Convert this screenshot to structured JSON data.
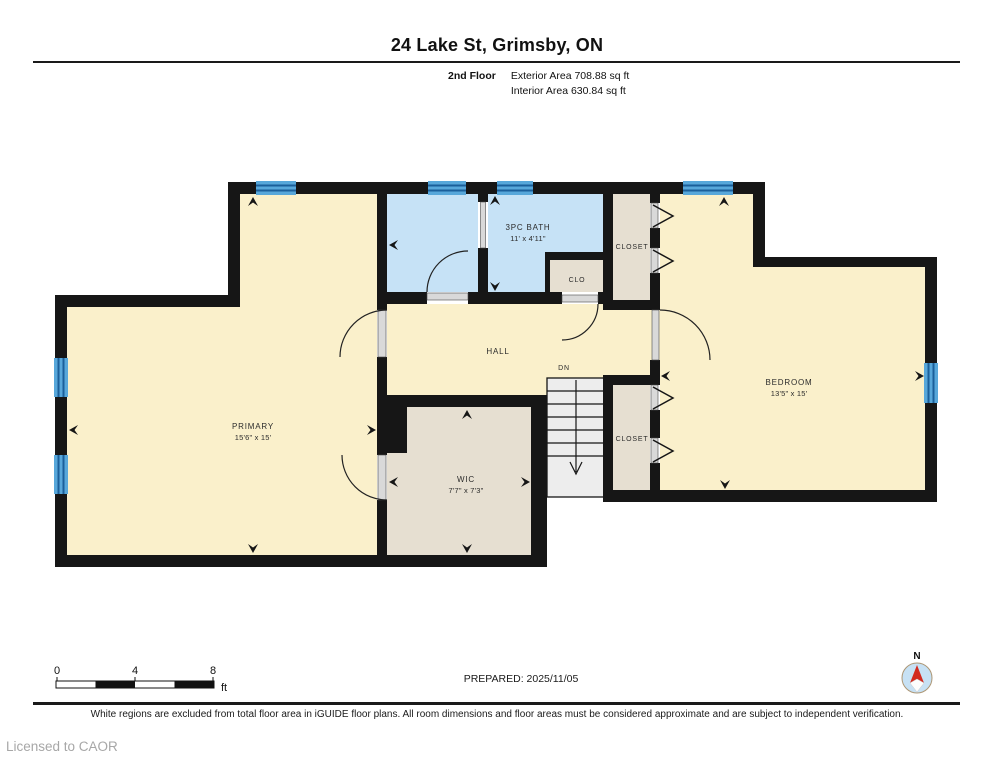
{
  "header": {
    "title": "24 Lake St, Grimsby, ON",
    "floor_label": "2nd Floor",
    "exterior_area": "Exterior Area 708.88 sq ft",
    "interior_area": "Interior Area 630.84 sq ft"
  },
  "rooms": {
    "primary": {
      "label": "PRIMARY",
      "dims": "15'6\" x 15'"
    },
    "hall": {
      "label": "HALL"
    },
    "stairs": {
      "label": "DN"
    },
    "wic": {
      "label": "WIC",
      "dims": "7'7\" x 7'3\""
    },
    "bath": {
      "label": "3PC BATH",
      "dims": "11' x 4'11\""
    },
    "closet_upper": {
      "label": "CLOSET"
    },
    "clo": {
      "label": "CLO"
    },
    "closet_lower": {
      "label": "CLOSET"
    },
    "bedroom": {
      "label": "BEDROOM",
      "dims": "13'5\" x 15'"
    }
  },
  "scale_bar": {
    "tick_0": "0",
    "tick_4": "4",
    "tick_8": "8",
    "unit": "ft"
  },
  "compass": {
    "north_label": "N"
  },
  "footer": {
    "prepared": "PREPARED: 2025/11/05",
    "disclaimer": "White regions are excluded from total floor area in iGUIDE floor plans. All room dimensions and floor areas must be considered approximate and are subject to independent verification.",
    "license": "Licensed to CAOR"
  },
  "colors": {
    "wall": "#161616",
    "room_cream": "#FAF0CB",
    "room_blue": "#C6E2F6",
    "room_beige": "#E6DFD1",
    "window_blue": "#57A7DA",
    "window_stripe": "#1B5F9A",
    "stairs_fill": "#EDEDED",
    "door_panel": "#D9D9D9",
    "compass_red": "#D22A1F",
    "license_gray": "#A7A7A7"
  }
}
